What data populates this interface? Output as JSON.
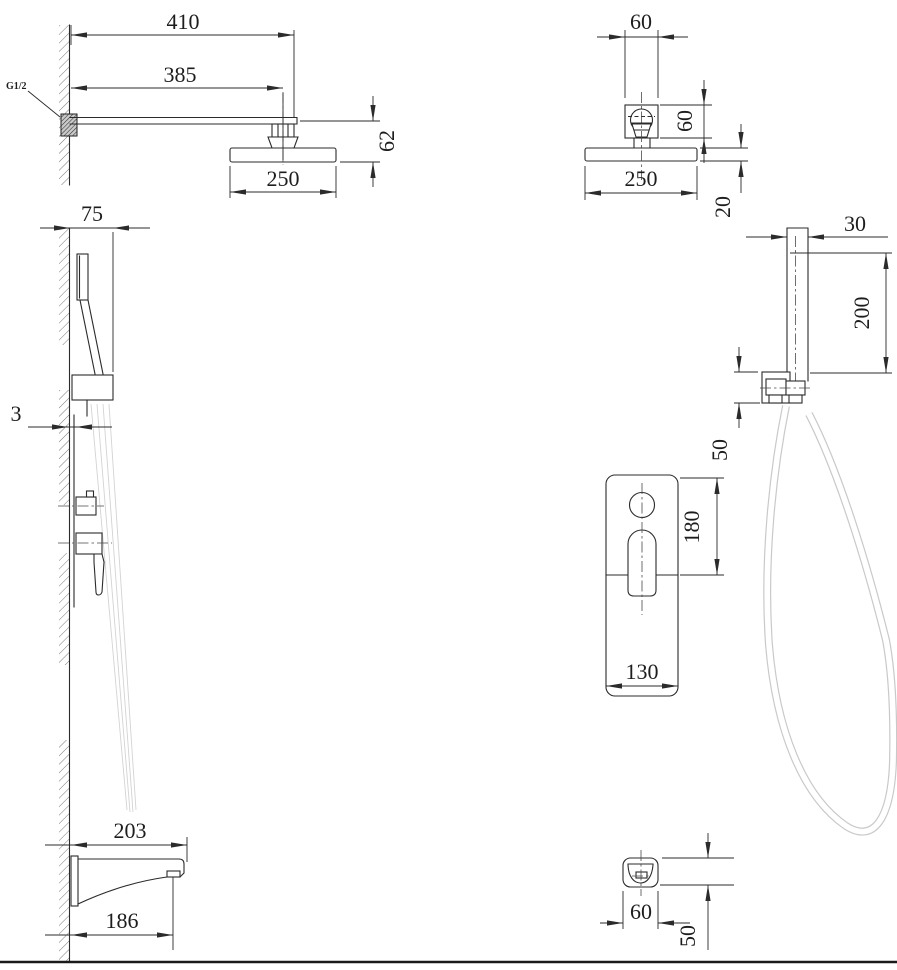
{
  "drawing": {
    "thread_label": "G1/2",
    "dims": {
      "arm_overall": "410",
      "arm_length": "385",
      "head_drop": "62",
      "head_width_side": "250",
      "bracket_width": "60",
      "bracket_height": "60",
      "head_width_front": "250",
      "head_thickness": "20",
      "holder_depth": "75",
      "plate_offset": "3",
      "bar_width": "30",
      "bar_length": "200",
      "holder_height": "50",
      "mixer_plate_height": "180",
      "mixer_plate_width": "130",
      "spout_length_overall": "203",
      "spout_length_outlet": "186",
      "spout_width": "60",
      "spout_height": "50"
    }
  }
}
